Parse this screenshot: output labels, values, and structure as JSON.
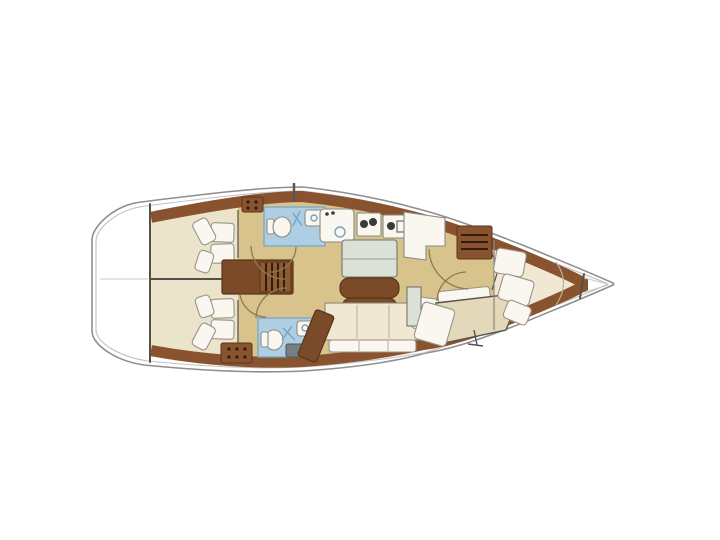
{
  "diagram": {
    "type": "sailboat-interior-floorplan",
    "orientation": {
      "bow": "right",
      "stern": "left"
    },
    "rooms": [
      {
        "id": "aft-cabin-starboard",
        "label": "aft double cabin with pillows (upper)"
      },
      {
        "id": "aft-cabin-port",
        "label": "aft double cabin with pillows (lower)"
      },
      {
        "id": "head-starboard",
        "label": "bathroom with toilet and sink (upper)"
      },
      {
        "id": "head-port",
        "label": "bathroom with toilet, sink and counter (lower)"
      },
      {
        "id": "companionway",
        "label": "companionway steps"
      },
      {
        "id": "galley",
        "label": "galley with sink, stove, oven and L-counter"
      },
      {
        "id": "saloon",
        "label": "saloon table, folding leaves and settee"
      },
      {
        "id": "nav-station",
        "label": "chart table and navigator seat"
      },
      {
        "id": "forward-cabin",
        "label": "V-berth double cabin with pillows"
      },
      {
        "id": "anchor-locker",
        "label": "bow anchor locker"
      }
    ],
    "symbols": [
      {
        "id": "stern-marker",
        "shape": "diamond"
      },
      {
        "id": "mast",
        "shape": "line"
      }
    ]
  },
  "palette": {
    "hull_fill": "#ffffff",
    "hull_line": "#8f8f8f",
    "hull_line_light": "#c2c2c2",
    "deck_wood": "#8a5330",
    "wood_dark": "#5a3418",
    "stairs_wood": "#7b4a28",
    "floor_tan": "#d7c38b",
    "bed_beige": "#ebe3ca",
    "bed_cream": "#f0e8d3",
    "cushion_white": "#f9f7f0",
    "head_blue": "#aecfe3",
    "head_accent": "#76a3c2",
    "table_top": "#dce1d7",
    "counter_gray": "#767d83",
    "wall_dark": "#55504a",
    "arc_line": "#8d7b50",
    "burner_dark": "#3a3a3a",
    "marker_gray": "#4a4a4a"
  }
}
